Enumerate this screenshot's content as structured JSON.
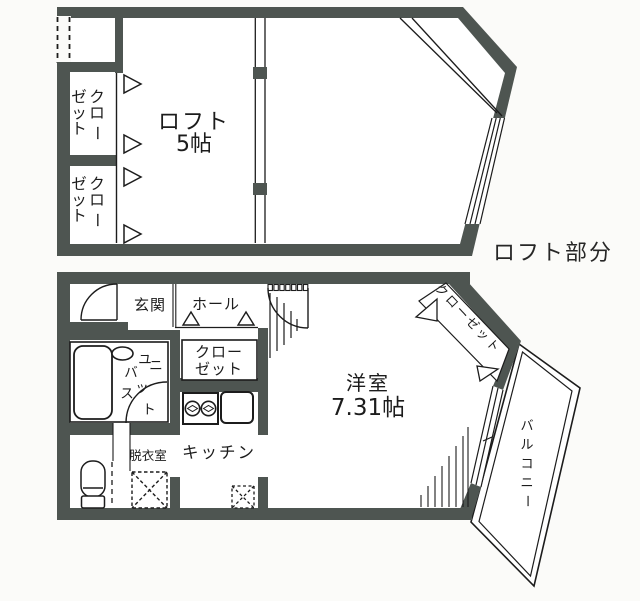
{
  "colors": {
    "wall": "#4e5551",
    "line": "#1c1c1c",
    "background": "#fbfbf9",
    "room": "#ffffff"
  },
  "upper_plan": {
    "room_label": "ロフト",
    "room_size": "5帖",
    "caption": "ロフト部分",
    "closet_right_chars": [
      "ク",
      "ロ",
      "ー"
    ],
    "closet_left_chars": [
      "ゼ",
      "ッ",
      "ト"
    ]
  },
  "lower_plan": {
    "entrance": "玄関",
    "hall": "ホール",
    "closet_line1": "クロー",
    "closet_line2": "ゼット",
    "unit_bath_chars": [
      "ユ",
      "ニ",
      "バ",
      "ス",
      "ッ",
      "ト"
    ],
    "dressing_room": "脱衣室",
    "kitchen": "キッチン",
    "room_label": "洋室",
    "room_size": "7.31帖",
    "diagonal_closet": "クローゼット",
    "balcony_chars": [
      "バ",
      "ル",
      "コ",
      "ニ",
      "ー"
    ]
  }
}
